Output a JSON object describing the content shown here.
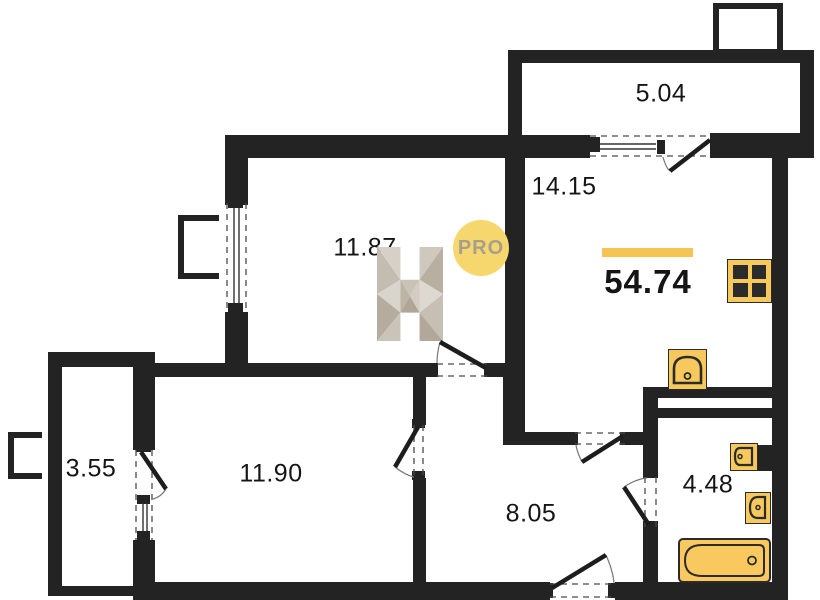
{
  "plan": {
    "areas": {
      "balcony_top": "5.04",
      "kitchen_living": "14.15",
      "bedroom": "11.87",
      "total": "54.74",
      "balcony_left": "3.55",
      "room_bottom": "11.90",
      "hallway": "8.05",
      "bathroom": "4.48"
    },
    "watermark": {
      "logo_letter": "H",
      "badge": "PRO"
    },
    "fixtures": {
      "kitchen": [
        "stove-icon",
        "kitchen-sink-icon"
      ],
      "bathroom": [
        "washbasin-icon",
        "toilet-icon",
        "bathtub-icon"
      ]
    },
    "colors": {
      "wall": "#232323",
      "fixture_fill": "#F7C85C",
      "fixture_stroke": "#2B2B2B",
      "accent_bar": "#F6C453",
      "badge_bg": "#F6D76E",
      "badge_text": "#A79E8B"
    }
  }
}
